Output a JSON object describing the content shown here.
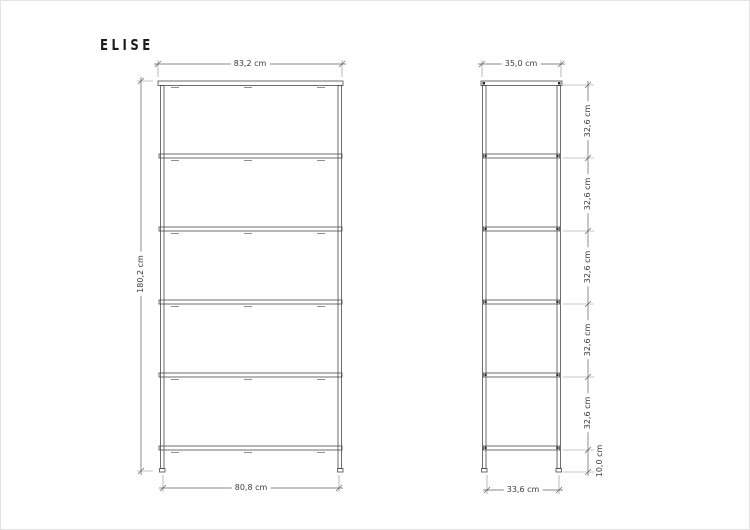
{
  "brand": {
    "logo": "ELISE"
  },
  "colors": {
    "background": "#ffffff",
    "object_line": "#4a4a4a",
    "dimension_line": "#5a5a5a",
    "text": "#3c3c3c"
  },
  "views": {
    "front": {
      "label": "front view",
      "width_top": "83,2 cm",
      "width_bottom": "80,8 cm",
      "height": "180,2 cm"
    },
    "side": {
      "label": "side view",
      "depth_top": "35,0 cm",
      "depth_bottom": "33,6 cm",
      "shelf_spacings": [
        "32,6 cm",
        "32,6 cm",
        "32,6 cm",
        "32,6 cm",
        "32,6 cm"
      ],
      "base_height": "10,0 cm"
    }
  }
}
